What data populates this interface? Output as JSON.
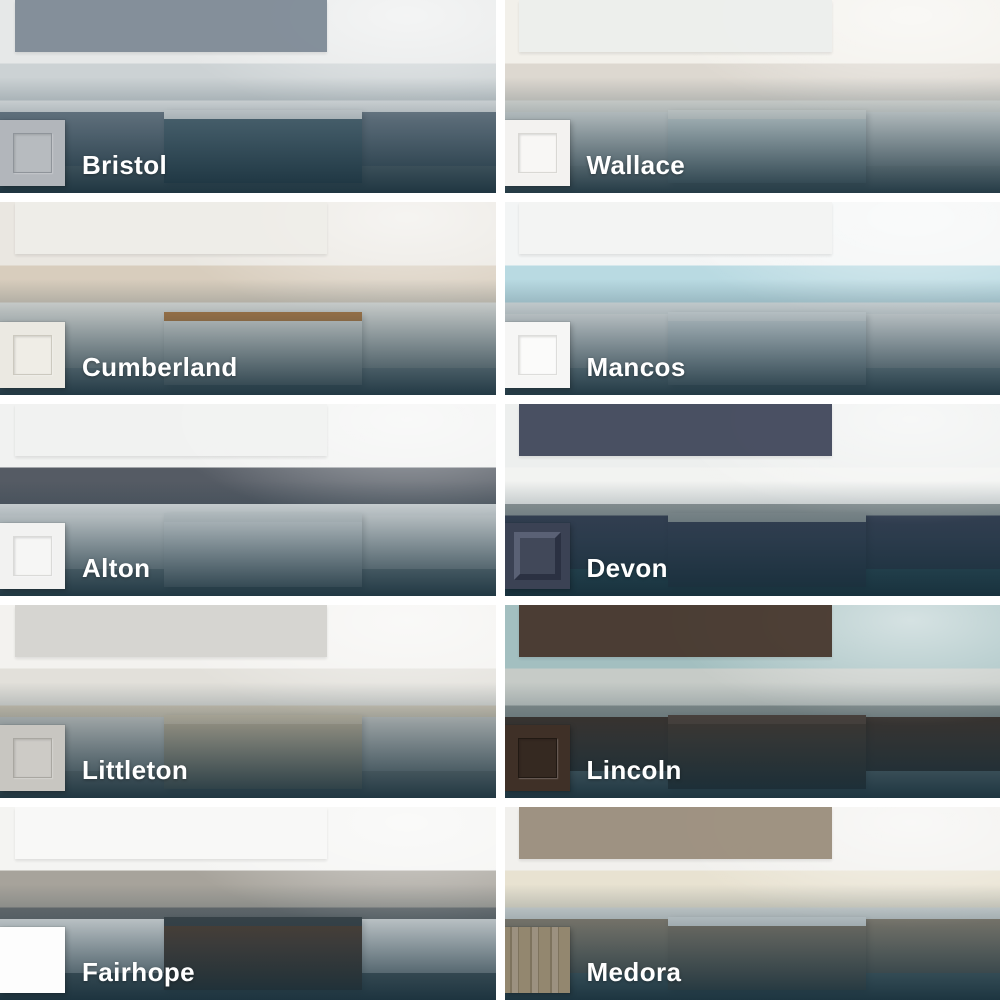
{
  "page": {
    "background_color": "#ffffff",
    "overlay_color": "#19333f",
    "label_color": "#ffffff"
  },
  "tiles": [
    {
      "name": "Bristol",
      "swatch": {
        "style": "shaker",
        "face": "#b7bbbf",
        "frame": "#b2b6bb",
        "line": "#8f949a"
      },
      "photo": {
        "wall": "#e6e8e8",
        "splash": "#ccd2d4",
        "counter": "#f1f2f2",
        "cab": "#7c8894",
        "floor": "#98a0a4",
        "island": "#5c737f",
        "island_top": "#f3f4f4"
      }
    },
    {
      "name": "Wallace",
      "swatch": {
        "style": "shaker",
        "face": "#f8f7f5",
        "frame": "#f3f2f0",
        "line": "#d9d8d4"
      },
      "photo": {
        "wall": "#f2f0ea",
        "splash": "#ddd8d0",
        "counter": "#ecebe5",
        "cab": "#edefed",
        "floor": "#e2e4e0",
        "island": "#dfe8e8",
        "island_top": "#f1f2ee"
      }
    },
    {
      "name": "Cumberland",
      "swatch": {
        "style": "shaker",
        "face": "#efede6",
        "frame": "#ebe9e2",
        "line": "#ccc9bf"
      },
      "photo": {
        "wall": "#eae7e1",
        "splash": "#d8cdbd",
        "counter": "#eeede8",
        "cab": "#efeee9",
        "floor": "#c8cfd0",
        "island": "#f0efea",
        "island_top": "#c08448"
      }
    },
    {
      "name": "Mancos",
      "swatch": {
        "style": "shaker",
        "face": "#fbfbfa",
        "frame": "#f6f6f5",
        "line": "#dddddb"
      },
      "photo": {
        "wall": "#f3f5f5",
        "splash": "#b9dae2",
        "counter": "#e8ecec",
        "cab": "#f3f4f3",
        "floor": "#c9d5d8",
        "island": "#e2e9eb",
        "island_top": "#eff2f2"
      }
    },
    {
      "name": "Alton",
      "swatch": {
        "style": "shaker",
        "face": "#f6f6f5",
        "frame": "#f2f2f1",
        "line": "#dadad8"
      },
      "photo": {
        "wall": "#f1f2f1",
        "splash": "#555b64",
        "counter": "#edefef",
        "cab": "#f2f3f2",
        "floor": "#b4bdbf",
        "island": "#eef0f0",
        "island_top": "#e6e9e9"
      }
    },
    {
      "name": "Devon",
      "swatch": {
        "style": "raised",
        "face": "#414859",
        "frame": "#3b4254",
        "hi": "#5a6175",
        "shadow": "#2b3142"
      },
      "photo": {
        "wall": "#edefee",
        "splash": "#f2f3f1",
        "counter": "#99a0a0",
        "cab": "#3c4357",
        "floor": "#3d6570",
        "island": "#3c4357",
        "island_top": "#99a0a0"
      }
    },
    {
      "name": "Littleton",
      "swatch": {
        "style": "shaker",
        "face": "#cdcbc6",
        "frame": "#c8c6c1",
        "line": "#a9a7a1"
      },
      "photo": {
        "wall": "#f3f2ef",
        "splash": "#e2e0da",
        "counter": "#d8cdb9",
        "cab": "#d4d3cf",
        "floor": "#b6b4ae",
        "island": "#c9b99f",
        "island_top": "#d9cbb3"
      }
    },
    {
      "name": "Lincoln",
      "swatch": {
        "style": "shaker",
        "face": "#352921",
        "frame": "#3f3027",
        "line": "#211913"
      },
      "photo": {
        "wall": "#a3bfc0",
        "splash": "#c6cbc7",
        "counter": "#8d9694",
        "cab": "#443329",
        "floor": "#8d999a",
        "island": "#4a382c",
        "island_top": "#59453a"
      }
    },
    {
      "name": "Fairhope",
      "swatch": {
        "style": "slab",
        "face": "#fdfdfd"
      },
      "photo": {
        "wall": "#f4f4f2",
        "splash": "#a7a39b",
        "counter": "#6e7173",
        "cab": "#f9f9f8",
        "floor": "#7d8688",
        "island": "#5d4434",
        "island_top": "#41474a"
      }
    },
    {
      "name": "Medora",
      "swatch": {
        "style": "wood",
        "face": "#93876f",
        "grain": "#7e735e",
        "face2": "#9c9180"
      },
      "photo": {
        "wall": "#f1f0ed",
        "splash": "#e8e2d1",
        "counter": "#dde1e0",
        "cab": "#988b79",
        "floor": "#7e9496",
        "island": "#8e8170",
        "island_top": "#e7ebeb"
      }
    }
  ]
}
